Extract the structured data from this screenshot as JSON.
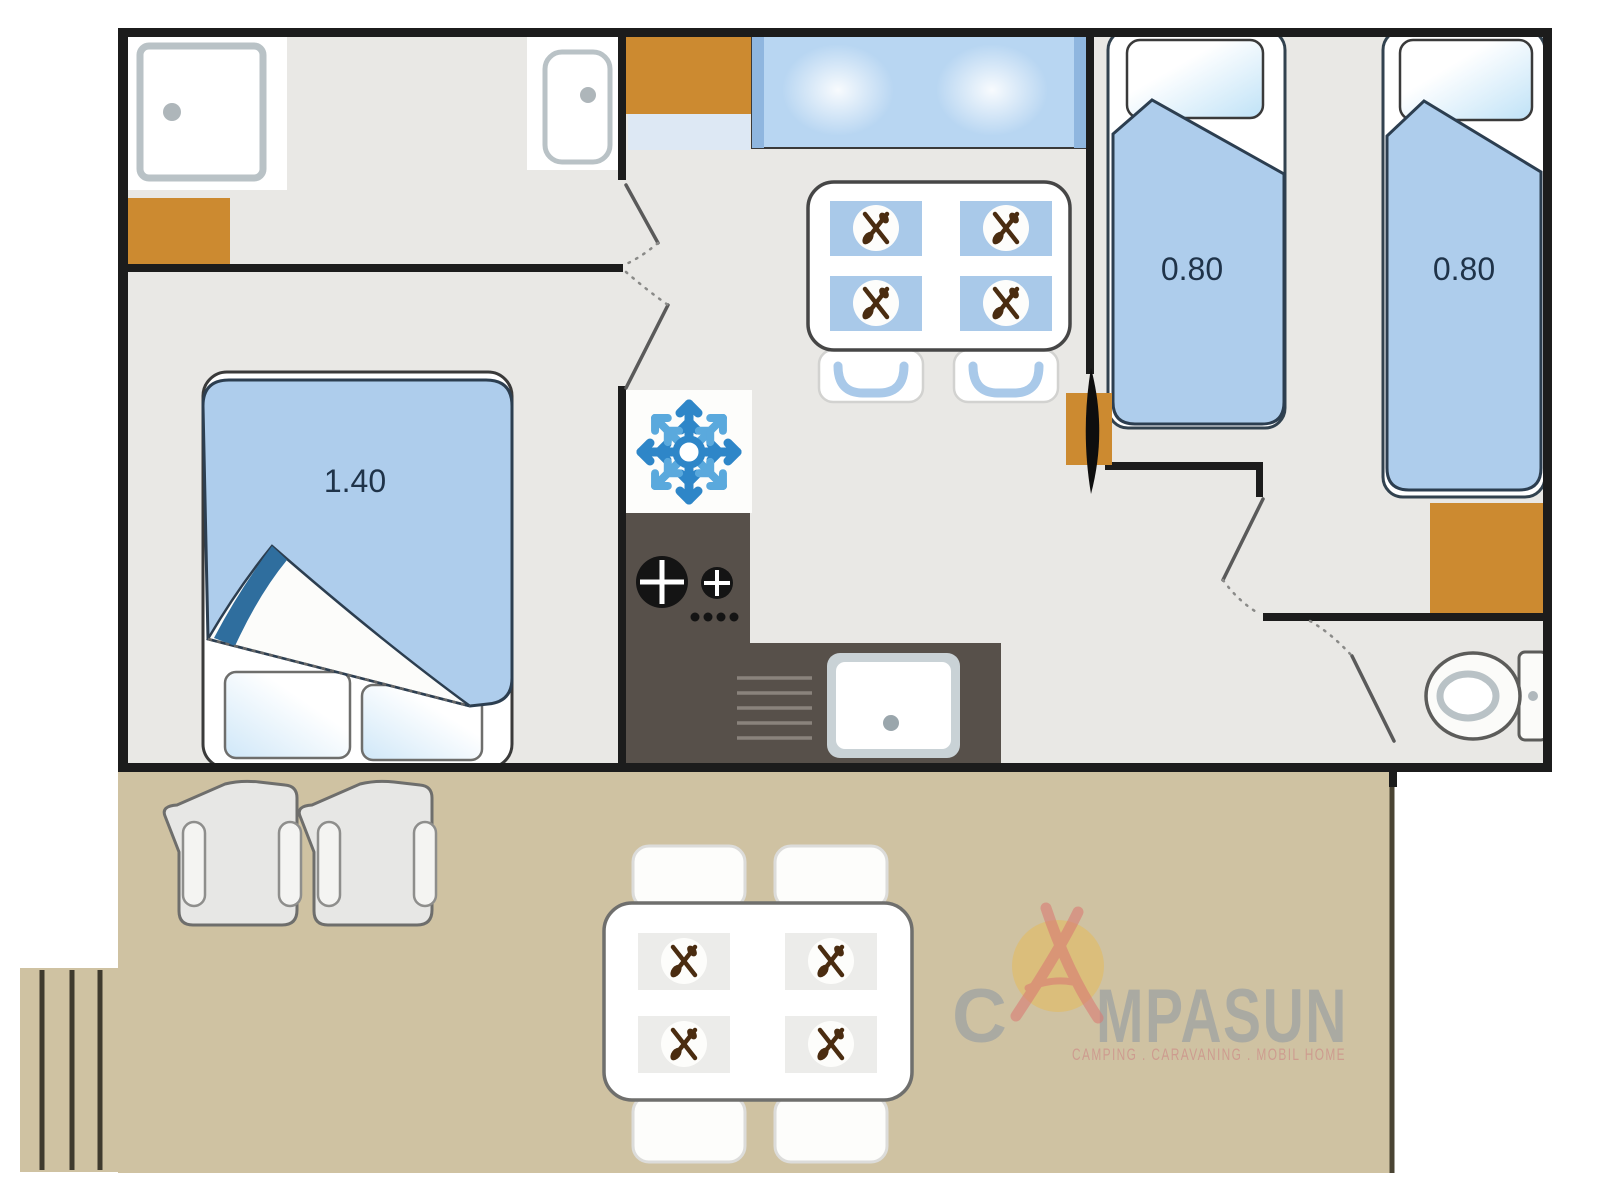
{
  "plan": {
    "master_bed": {
      "label": "1.40"
    },
    "twin_bed_left": {
      "label": "0.80"
    },
    "twin_bed_right": {
      "label": "0.80"
    }
  },
  "watermark": {
    "brand_full": "CAMPASUN",
    "brand_c": "C",
    "brand_rest": "MPASUN",
    "tagline": "CAMPING . CARAVANING . MOBIL HOME"
  },
  "icons": {
    "fridge": "snowflake-icon",
    "place_setting": "crossed-cutlery-icon",
    "shower_drain": "drain-dot-icon",
    "basin_drain": "drain-dot-icon"
  },
  "colors": {
    "wall": "#1c1c1c",
    "floor": "#e9e8e5",
    "accent_orange": "#cc8a30",
    "soft_blue": "#aecdec",
    "placemat_blue": "#a9c9e9",
    "window_blue": "#b8d6f2",
    "counter_dark": "#57504a",
    "terrace_tan": "#cfc2a2",
    "terrace_edge": "#4a4433",
    "bed_outline": "#2c3e50",
    "snowflake_blue": "#2e86c8",
    "snowflake_light": "#5aa9dd",
    "logo_gray": "#8d98a3",
    "logo_red": "#cd8c88",
    "logo_a_red": "#d97b74",
    "sun_yellow": "#f0b93c"
  }
}
